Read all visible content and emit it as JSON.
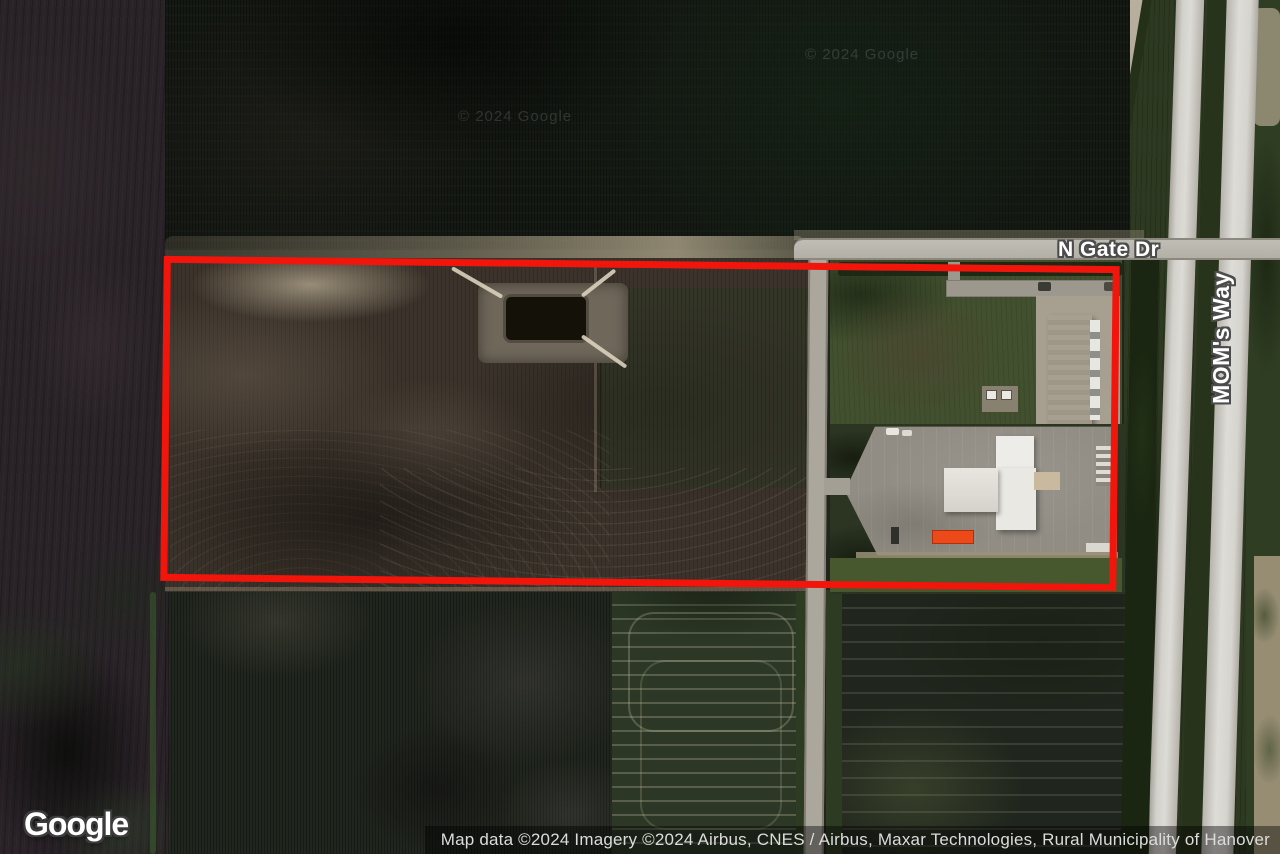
{
  "map": {
    "provider": "Google",
    "road_labels": [
      {
        "label": "N Gate Dr"
      },
      {
        "label": "MOM's Way"
      }
    ],
    "watermark": "© 2024 Google",
    "attribution": "Map data ©2024 Imagery ©2024 Airbus, CNES / Airbus, Maxar Technologies, Rural Municipality of Hanover",
    "overlay": {
      "type": "parcel-boundary-rectangle",
      "stroke_color": "#f2150b"
    },
    "imagery": {
      "type": "satellite",
      "features": [
        "plowed dark farm fields",
        "rectangular retention pond with dirt paths",
        "long warehouse with loading docks",
        "commercial building complex",
        "large parking lot",
        "orange trailer",
        "north-south local road",
        "divided highway with grass median"
      ]
    }
  }
}
